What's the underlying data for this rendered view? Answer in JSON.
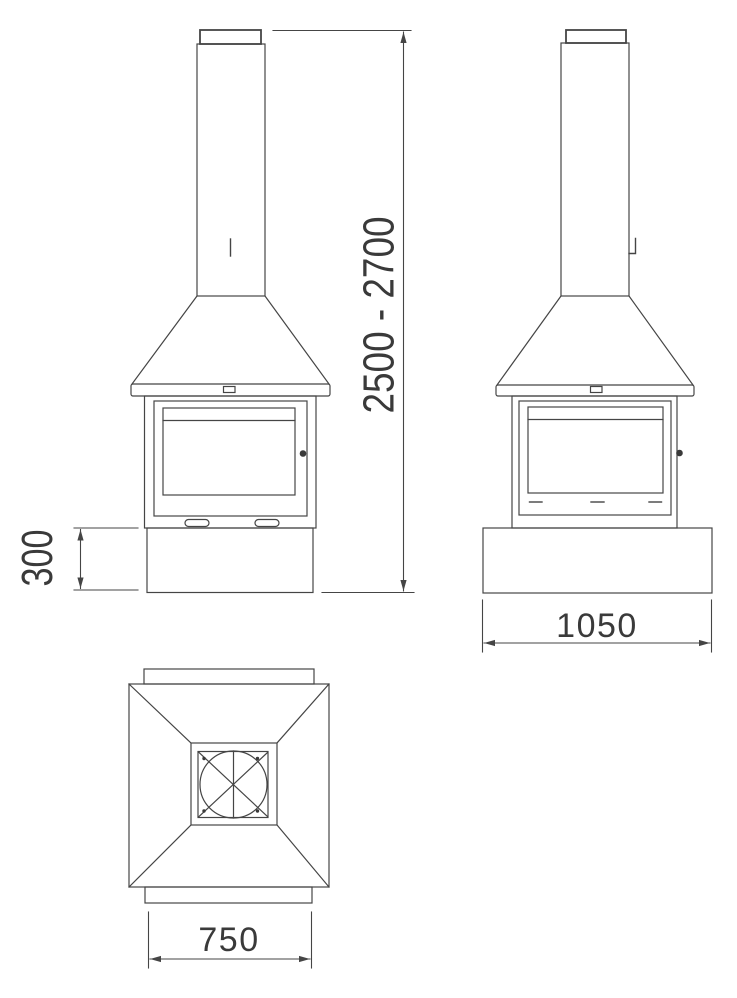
{
  "labels": {
    "overall_height": "2500 - 2700",
    "plinth_height": "300",
    "base_width": "1050",
    "hood_top_width": "750"
  },
  "colors": {
    "line": "#454545",
    "text": "#3a3a3a",
    "background": "#ffffff"
  }
}
